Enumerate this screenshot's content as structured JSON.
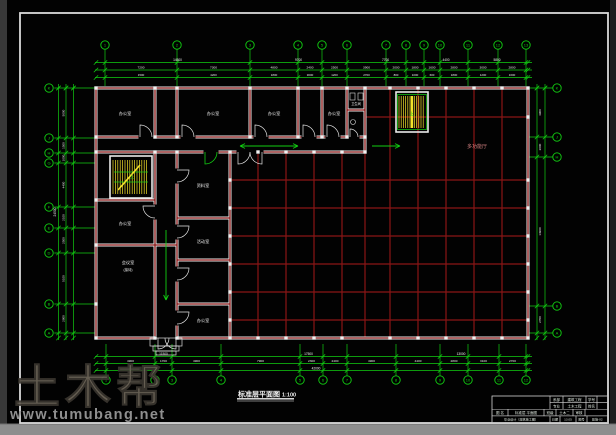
{
  "watermark": {
    "brand": "土木帮",
    "url": "www.tumubang.net"
  },
  "drawing": {
    "title": "标准层平面图",
    "scale": "1:100"
  },
  "hall_label": "多功能厅",
  "stair_up_label": "上",
  "rooms": [
    {
      "t": "办公室",
      "x": 125,
      "y": 115,
      "s": 4.2,
      "c": "#eeeeee"
    },
    {
      "t": "办公室",
      "x": 213,
      "y": 115,
      "s": 4.2,
      "c": "#eeeeee"
    },
    {
      "t": "办公室",
      "x": 274,
      "y": 115,
      "s": 4.2,
      "c": "#eeeeee"
    },
    {
      "t": "办公室",
      "x": 334,
      "y": 115,
      "s": 4.2,
      "c": "#eeeeee"
    },
    {
      "t": "卫生间",
      "x": 356,
      "y": 105,
      "s": 3.2,
      "c": "#eeeeee"
    },
    {
      "t": "资料室",
      "x": 203,
      "y": 187,
      "s": 4.2,
      "c": "#eeeeee"
    },
    {
      "t": "办公室",
      "x": 125,
      "y": 225,
      "s": 4.2,
      "c": "#eeeeee"
    },
    {
      "t": "会议室",
      "x": 128,
      "y": 264,
      "s": 4.2,
      "c": "#eeeeee"
    },
    {
      "t": "(接待)",
      "x": 128,
      "y": 271,
      "s": 3.4,
      "c": "#eeeeee"
    },
    {
      "t": "活动室",
      "x": 203,
      "y": 243,
      "s": 4.2,
      "c": "#eeeeee"
    },
    {
      "t": "办公室",
      "x": 203,
      "y": 322,
      "s": 4.2,
      "c": "#eeeeee"
    },
    {
      "t": "多功能厅",
      "x": 477,
      "y": 148,
      "s": 5,
      "c": "#d08080"
    }
  ],
  "grid": {
    "top": [
      {
        "label": "1",
        "x": 105
      },
      {
        "label": "2",
        "x": 177
      },
      {
        "label": "3",
        "x": 250
      },
      {
        "label": "4",
        "x": 298
      },
      {
        "label": "5",
        "x": 322
      },
      {
        "label": "6",
        "x": 347
      },
      {
        "label": "7",
        "x": 386
      },
      {
        "label": "8",
        "x": 406
      },
      {
        "label": "9",
        "x": 424
      },
      {
        "label": "10",
        "x": 440
      },
      {
        "label": "11",
        "x": 468
      },
      {
        "label": "12",
        "x": 498
      },
      {
        "label": "13",
        "x": 526
      }
    ],
    "bottom": [
      {
        "label": "1",
        "x": 106
      },
      {
        "label": "2",
        "x": 155
      },
      {
        "label": "3",
        "x": 172
      },
      {
        "label": "4",
        "x": 221
      },
      {
        "label": "5",
        "x": 300
      },
      {
        "label": "6",
        "x": 323
      },
      {
        "label": "7",
        "x": 347
      },
      {
        "label": "8",
        "x": 396
      },
      {
        "label": "9",
        "x": 440
      },
      {
        "label": "10",
        "x": 468
      },
      {
        "label": "11",
        "x": 499
      },
      {
        "label": "12",
        "x": 526
      }
    ],
    "left": [
      {
        "label": "K",
        "y": 88
      },
      {
        "label": "J",
        "y": 138
      },
      {
        "label": "H",
        "y": 153
      },
      {
        "label": "G",
        "y": 163
      },
      {
        "label": "F",
        "y": 207
      },
      {
        "label": "E",
        "y": 228
      },
      {
        "label": "D",
        "y": 253
      },
      {
        "label": "B",
        "y": 304
      },
      {
        "label": "A",
        "y": 333
      }
    ],
    "right": [
      {
        "label": "K",
        "y": 88
      },
      {
        "label": "J",
        "y": 137
      },
      {
        "label": "H",
        "y": 157
      },
      {
        "label": "B",
        "y": 306
      },
      {
        "label": "A",
        "y": 333
      }
    ]
  },
  "dimensions": {
    "top_row1": [
      "14500",
      "9700",
      "7700",
      "4400",
      "5800"
    ],
    "top_row2": [
      "7200",
      "7300",
      "4800",
      "2400",
      "2500",
      "3900",
      "2000",
      "1800",
      "1600",
      "2800",
      "3000",
      "2800"
    ],
    "top_row3": [
      "1500",
      "4200",
      "1800",
      "3000",
      "1200",
      "2700",
      "800",
      "1000",
      "600",
      "1800",
      "1200",
      "1600"
    ],
    "bottom_row1": [
      "11500",
      "17500",
      "13000"
    ],
    "bottom_row2": [
      "4900",
      "1700",
      "4900",
      "7900",
      "2300",
      "2400",
      "4900",
      "4400",
      "2800",
      "3100",
      "2700"
    ],
    "bottom_overall": "42000",
    "left_col": [
      "5000",
      "1500",
      "1000",
      "4400",
      "2100",
      "2500",
      "5100",
      "2900"
    ],
    "left_overall": "24500",
    "right_col": [
      "4900",
      "2000",
      "14900",
      "2700"
    ]
  },
  "title_block": {
    "r1": [
      "系部",
      "建筑工程",
      "学号",
      ""
    ],
    "r2": [
      "专业",
      "土木工程",
      "姓名",
      ""
    ],
    "r3": [
      "图 名",
      "标准层 平面图",
      "班级",
      "土木二",
      "审核",
      ""
    ],
    "r4": [
      "毕业设计（建筑施工图）",
      "日期",
      "13.05",
      "图号",
      "建施-02"
    ]
  },
  "colors": {
    "line_green": "#12cf12",
    "beam_red": "#8a1515",
    "wall_white": "#ebebeb",
    "stair_yellow": "#f2e22a",
    "text_white": "#f0f0f0",
    "watermark_gray": "#6e6659",
    "strip_gray": "#8e8e8e"
  }
}
